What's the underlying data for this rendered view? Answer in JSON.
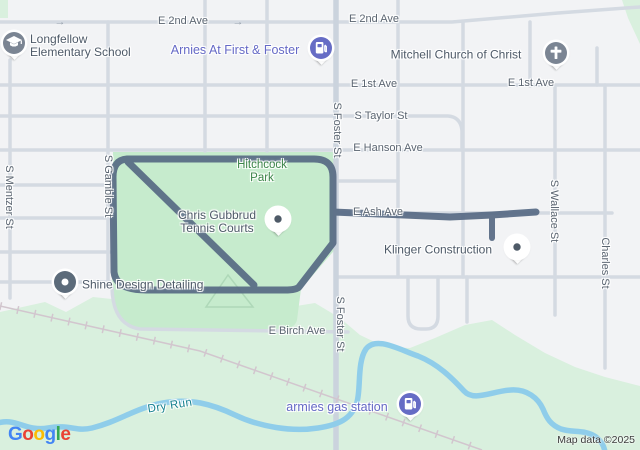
{
  "attribution": "Map data ©2025",
  "logo_letters": [
    {
      "ch": "G",
      "color": "#4285F4"
    },
    {
      "ch": "o",
      "color": "#EA4335"
    },
    {
      "ch": "o",
      "color": "#FBBC05"
    },
    {
      "ch": "g",
      "color": "#4285F4"
    },
    {
      "ch": "l",
      "color": "#34A853"
    },
    {
      "ch": "e",
      "color": "#EA4335"
    }
  ],
  "colors": {
    "background": "#f2f3f5",
    "road": "#d4dae2",
    "road_major": "#cbd3dd",
    "park": "#c6ebcd",
    "landcover": "#d9f0de",
    "water": "#8fcdea",
    "railroad": "#d2c6ce",
    "route": "#576a84",
    "path": "#aed8b8"
  },
  "street_labels": [
    {
      "text": "E 2nd Ave",
      "x": 183,
      "y": 21,
      "dir": "h"
    },
    {
      "text": "E 2nd Ave",
      "x": 374,
      "y": 19,
      "dir": "h"
    },
    {
      "text": "E 1st Ave",
      "x": 374,
      "y": 84,
      "dir": "h"
    },
    {
      "text": "E 1st Ave",
      "x": 531,
      "y": 83,
      "dir": "h"
    },
    {
      "text": "S Taylor St",
      "x": 381,
      "y": 116,
      "dir": "h"
    },
    {
      "text": "E Hanson Ave",
      "x": 388,
      "y": 148,
      "dir": "h"
    },
    {
      "text": "E Ash Ave",
      "x": 378,
      "y": 212,
      "dir": "h"
    },
    {
      "text": "E Birch Ave",
      "x": 297,
      "y": 331,
      "dir": "h"
    },
    {
      "text": "S Mentzer St",
      "x": 9,
      "y": 197,
      "dir": "v"
    },
    {
      "text": "S Gamble St",
      "x": 108,
      "y": 186,
      "dir": "v"
    },
    {
      "text": "S Foster St",
      "x": 337,
      "y": 130,
      "dir": "v"
    },
    {
      "text": "S Foster St",
      "x": 340,
      "y": 324,
      "dir": "v"
    },
    {
      "text": "S Wallace St",
      "x": 554,
      "y": 211,
      "dir": "v"
    },
    {
      "text": "Charles St",
      "x": 605,
      "y": 263,
      "dir": "v"
    }
  ],
  "oneway_arrows": [
    {
      "glyph": "→",
      "x": 60,
      "y": 22
    },
    {
      "glyph": "→",
      "x": 238,
      "y": 22
    }
  ],
  "area_labels": [
    {
      "name": "hitchcock-park-label",
      "lines": [
        "Hitchcock",
        "Park"
      ],
      "x": 262,
      "y": 172,
      "kind": "park",
      "rot": 0
    },
    {
      "name": "dry-run-label",
      "lines": [
        "Dry Run"
      ],
      "x": 170,
      "y": 406,
      "kind": "water",
      "rot": -9
    }
  ],
  "pois": [
    {
      "name": "longfellow-elementary-school",
      "lines": [
        "Longfellow",
        "Elementary School"
      ],
      "label_x": 30,
      "label_y": 46,
      "align": "left",
      "kind": "poi",
      "pin": {
        "icon": "school-icon",
        "style": "gray",
        "x": 14,
        "y": 43
      }
    },
    {
      "name": "arnies-at-first-and-foster",
      "lines": [
        "Arnies At First & Foster"
      ],
      "label_x": 235,
      "label_y": 50,
      "align": "center",
      "kind": "purple",
      "pin": {
        "icon": "fuel-icon",
        "style": "purple",
        "x": 321,
        "y": 48
      }
    },
    {
      "name": "mitchell-church-of-christ",
      "lines": [
        "Mitchell Church of Christ"
      ],
      "label_x": 456,
      "label_y": 55,
      "align": "center",
      "kind": "poi",
      "pin": {
        "icon": "church-icon",
        "style": "gray",
        "x": 556,
        "y": 53
      }
    },
    {
      "name": "chris-gubbrud-tennis-courts",
      "lines": [
        "Chris Gubbrud",
        "Tennis Courts"
      ],
      "label_x": 217,
      "label_y": 222,
      "align": "center",
      "kind": "poi",
      "pin": {
        "icon": "dot-icon",
        "style": "white",
        "x": 278,
        "y": 219
      }
    },
    {
      "name": "klinger-construction",
      "lines": [
        "Klinger Construction"
      ],
      "label_x": 438,
      "label_y": 250,
      "align": "center",
      "kind": "poi",
      "pin": {
        "icon": "dot-icon",
        "style": "white",
        "x": 517,
        "y": 247
      }
    },
    {
      "name": "shine-design-detailing",
      "lines": [
        "Shine Design Detailing"
      ],
      "label_x": 82,
      "label_y": 285,
      "align": "left",
      "kind": "poi",
      "pin": {
        "icon": "donut-icon",
        "style": "dark",
        "x": 65,
        "y": 282
      }
    },
    {
      "name": "armies-gas-station",
      "lines": [
        "armies gas station"
      ],
      "label_x": 337,
      "label_y": 407,
      "align": "center",
      "kind": "purple",
      "pin": {
        "icon": "fuel-icon",
        "style": "purple",
        "x": 410,
        "y": 404
      }
    }
  ]
}
